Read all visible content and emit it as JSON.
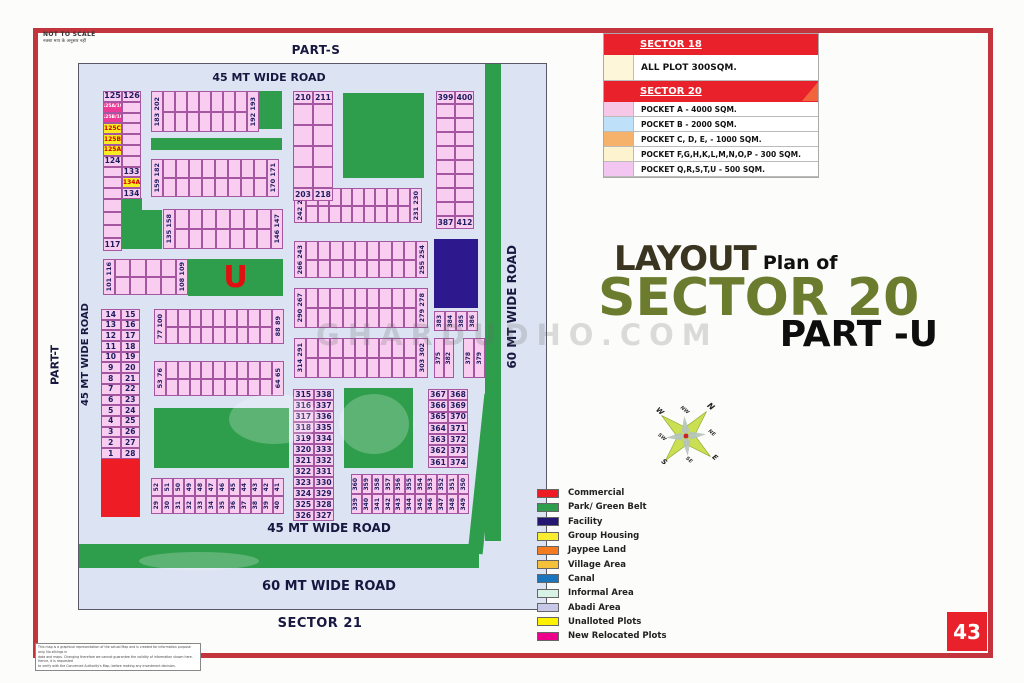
{
  "page": {
    "number": "43",
    "not_to_scale": "NOT TO SCALE",
    "not_to_scale_sub": "नक्शा माप के अनुसार नहीं",
    "watermark": "GHARDUDHO.COM",
    "disclaimer": {
      "l1": "This map is a graphical representation of the actual Map and is created for information purpose only. No sittings in",
      "l2": "data and maps. Changing therefore we cannot guarantee the validity of information shown here. Hence, it is requested",
      "l3": "to verify with the Concerned Authority's Map, before making any investment decision."
    }
  },
  "title": {
    "layout": "LAYOUT",
    "plan_of": "Plan of",
    "sector": "SECTOR 20",
    "part": "PART -U"
  },
  "legend_top": {
    "sector18_header": "SECTOR 18",
    "sector18_row": {
      "color": "#fdf6d8",
      "label": "ALL PLOT  300SQM."
    },
    "sector20_header": "SECTOR 20",
    "rows": [
      {
        "color": "#f6c7e7",
        "label": "POCKET A    -   4000 SQM."
      },
      {
        "color": "#bfe0f9",
        "label": "POCKET B    -   2000 SQM."
      },
      {
        "color": "#f6b26b",
        "label": "POCKET C, D, E, - 1000 SQM."
      },
      {
        "color": "#fdf3cf",
        "label": "POCKET  F,G,H,K,L,M,N,O,P  -  300 SQM."
      },
      {
        "color": "#f3c5f1",
        "label": "POCKET Q,R,S,T,U   -  500 SQM."
      }
    ]
  },
  "legend_bottom": {
    "items": [
      {
        "color": "#ed1c24",
        "label": "Commercial"
      },
      {
        "color": "#2f9e4c",
        "label": "Park/ Green Belt"
      },
      {
        "color": "#241773",
        "label": "Facility"
      },
      {
        "color": "#f9ed32",
        "label": "Group Housing"
      },
      {
        "color": "#f47b20",
        "label": "Jaypee Land"
      },
      {
        "color": "#f5c03a",
        "label": "Village Area"
      },
      {
        "color": "#1b75bc",
        "label": "Canal"
      },
      {
        "color": "#d9f2e6",
        "label": "Informal Area"
      },
      {
        "color": "#c7c8e8",
        "label": "Abadi Area"
      },
      {
        "color": "#fff200",
        "label": "Unalloted Plots"
      },
      {
        "color": "#ec008c",
        "label": "New Relocated Plots"
      }
    ]
  },
  "compass": {
    "labels": [
      "N",
      "NE",
      "E",
      "SE",
      "S",
      "SW",
      "W",
      "NW"
    ]
  },
  "map_labels": {
    "part_s": "PART-S",
    "part_t": "PART-T",
    "sector_21": "SECTOR 21"
  },
  "colors": {
    "green": "#2f9e4c",
    "navy": "#2e188e",
    "red": "#ee1c25",
    "magenta": "#ee3a97",
    "yellow": "#f9ec20",
    "plot": "#f8cdf0"
  },
  "map": {
    "blocks": [
      {
        "kind": "rect",
        "name": "green-belt-right",
        "x": 406,
        "y": 0,
        "w": 16,
        "h": 477,
        "color": "green"
      },
      {
        "kind": "rect",
        "name": "green-belt-right-lower",
        "x": 397,
        "y": 330,
        "w": 15,
        "h": 160,
        "color": "green",
        "tilt": 6
      },
      {
        "kind": "rect",
        "name": "park-band-top",
        "x": 72,
        "y": 74,
        "w": 131,
        "h": 12,
        "color": "green"
      },
      {
        "kind": "rect",
        "name": "park-square-small",
        "x": 180,
        "y": 27,
        "w": 23,
        "h": 38,
        "color": "green"
      },
      {
        "kind": "rect",
        "name": "park-square-large",
        "x": 264,
        "y": 29,
        "w": 81,
        "h": 85,
        "color": "green"
      },
      {
        "kind": "rect",
        "name": "park-L-upper",
        "x": 42,
        "y": 134,
        "w": 21,
        "h": 51,
        "color": "green"
      },
      {
        "kind": "rect",
        "name": "park-L-foot",
        "x": 63,
        "y": 146,
        "w": 20,
        "h": 39,
        "color": "green"
      },
      {
        "kind": "rect",
        "name": "park-left",
        "x": 75,
        "y": 344,
        "w": 135,
        "h": 60,
        "color": "green"
      },
      {
        "kind": "rect",
        "name": "park-right",
        "x": 265,
        "y": 324,
        "w": 69,
        "h": 80,
        "color": "green"
      },
      {
        "kind": "rect",
        "name": "green-band-bottom",
        "x": 0,
        "y": 480,
        "w": 400,
        "h": 24,
        "color": "green"
      },
      {
        "kind": "rect",
        "name": "facility-block",
        "x": 355,
        "y": 175,
        "w": 44,
        "h": 69,
        "color": "navy"
      },
      {
        "kind": "rect",
        "name": "commercial-block",
        "x": 22,
        "y": 395,
        "w": 39,
        "h": 58,
        "color": "red"
      },
      {
        "kind": "upark",
        "name": "park-u-block",
        "x": 109,
        "y": 195,
        "w": 95,
        "h": 37,
        "u": "U"
      },
      {
        "kind": "cellgrid",
        "name": "block-125-134",
        "x": 24,
        "y": 27,
        "cw": [
          19,
          19
        ],
        "rh": 10.8,
        "rows": [
          [
            {
              "t": "125",
              "fs": 8
            },
            {
              "t": "126",
              "fs": 8
            }
          ],
          [
            {
              "t": "125A/19",
              "bg": "magenta",
              "fg": "#fff",
              "fs": 4.5
            },
            {}
          ],
          [
            {
              "t": "125B/19",
              "bg": "magenta",
              "fg": "#fff",
              "fs": 4.5
            },
            {}
          ],
          [
            {
              "t": "125C",
              "bg": "yellow",
              "fg": "#c00",
              "fs": 6
            },
            {}
          ],
          [
            {
              "t": "125B",
              "bg": "yellow",
              "fg": "#c00",
              "fs": 6
            },
            {}
          ],
          [
            {
              "t": "125A",
              "bg": "yellow",
              "fg": "#c00",
              "fs": 6
            },
            {}
          ],
          [
            {
              "t": "124",
              "fs": 7.5
            },
            {}
          ],
          [
            {},
            {
              "t": "133",
              "fs": 7.5
            }
          ],
          [
            {},
            {
              "t": "134A",
              "bg": "yellow",
              "fg": "#c00",
              "fs": 6
            }
          ],
          [
            {},
            {
              "t": "134",
              "fs": 7.5
            }
          ]
        ]
      },
      {
        "kind": "cellgrid",
        "name": "block-117",
        "x": 24,
        "y": 135,
        "cw": [
          19
        ],
        "rh": 13,
        "rows": [
          [
            {}
          ],
          [
            {}
          ],
          [
            {}
          ],
          [
            {
              "t": "117",
              "fs": 7.5
            }
          ]
        ]
      },
      {
        "kind": "hstrip",
        "name": "strip-183-202",
        "x": 72,
        "y": 27,
        "w": 108,
        "h": 41,
        "cols": 7,
        "capL": "183 202",
        "capR": "192 193"
      },
      {
        "kind": "hstrip",
        "name": "strip-159-182",
        "x": 72,
        "y": 95,
        "w": 128,
        "h": 38,
        "cols": 8,
        "capL": "159 182",
        "capR": "170 171"
      },
      {
        "kind": "hstrip",
        "name": "strip-135-158",
        "x": 84,
        "y": 145,
        "w": 120,
        "h": 40,
        "cols": 7,
        "capL": "135 158",
        "capR": "146 147"
      },
      {
        "kind": "hstrip",
        "name": "strip-242-219",
        "x": 215,
        "y": 124,
        "w": 128,
        "h": 35,
        "cols": 9,
        "capL": "242 219",
        "capR": "231 230"
      },
      {
        "kind": "hstrip",
        "name": "strip-266-243",
        "x": 215,
        "y": 177,
        "w": 134,
        "h": 37,
        "cols": 9,
        "capL": "266 243",
        "capR": "255 254"
      },
      {
        "kind": "hstrip",
        "name": "strip-290-267",
        "x": 215,
        "y": 224,
        "w": 134,
        "h": 40,
        "cols": 9,
        "capL": "290 267",
        "capR": "279 278"
      },
      {
        "kind": "hstrip",
        "name": "strip-314-291",
        "x": 215,
        "y": 274,
        "w": 134,
        "h": 40,
        "cols": 9,
        "capL": "314 291",
        "capR": "303 302"
      },
      {
        "kind": "hstrip",
        "name": "strip-77-100",
        "x": 75,
        "y": 245,
        "w": 130,
        "h": 35,
        "cols": 9,
        "capL": "77 100",
        "capR": "88 89"
      },
      {
        "kind": "hstrip",
        "name": "strip-53-76",
        "x": 75,
        "y": 297,
        "w": 130,
        "h": 35,
        "cols": 9,
        "capL": "53 76",
        "capR": "64 65"
      },
      {
        "kind": "hstrip",
        "name": "strip-101-116",
        "x": 24,
        "y": 195,
        "w": 85,
        "h": 36,
        "cols": 4,
        "capL": "101 116",
        "capR": "108 109"
      },
      {
        "kind": "grid2",
        "name": "block-210-218",
        "x": 214,
        "y": 27,
        "w": 40,
        "h": 110,
        "top": [
          "210",
          "211"
        ],
        "bottom": [
          "203",
          "218"
        ],
        "mid": 4
      },
      {
        "kind": "grid2",
        "name": "block-399-412",
        "x": 357,
        "y": 27,
        "w": 38,
        "h": 138,
        "top": [
          "399",
          "400"
        ],
        "bottom": [
          "387",
          "412"
        ],
        "mid": 8
      },
      {
        "kind": "vcells",
        "name": "block-383-386",
        "x": 355,
        "y": 247,
        "w": 44,
        "h": 20,
        "labels": [
          "383",
          "384",
          "385",
          "386"
        ]
      },
      {
        "kind": "vcells",
        "name": "block-375-382",
        "x": 355,
        "y": 274,
        "w": 20,
        "h": 40,
        "labels": [
          "375",
          "382"
        ]
      },
      {
        "kind": "vcells",
        "name": "block-378-379",
        "x": 384,
        "y": 274,
        "w": 22,
        "h": 40,
        "labels": [
          "378",
          "379"
        ]
      },
      {
        "kind": "vpairs",
        "name": "strip-29-52",
        "x": 72,
        "y": 414,
        "w": 133,
        "h": 36,
        "top": [
          "52",
          "51",
          "50",
          "49",
          "48",
          "47",
          "46",
          "45",
          "44",
          "43",
          "42",
          "41"
        ],
        "bottom": [
          "29",
          "30",
          "31",
          "32",
          "33",
          "34",
          "35",
          "36",
          "37",
          "38",
          "39",
          "40"
        ]
      },
      {
        "kind": "vpairs",
        "name": "strip-339-360",
        "x": 272,
        "y": 410,
        "w": 118,
        "h": 40,
        "top": [
          "360",
          "359",
          "358",
          "357",
          "356",
          "355",
          "354",
          "353",
          "352",
          "351",
          "350"
        ],
        "bottom": [
          "339",
          "340",
          "341",
          "342",
          "343",
          "344",
          "345",
          "346",
          "347",
          "348",
          "349"
        ]
      },
      {
        "kind": "paircol",
        "name": "block-1-28",
        "x": 22,
        "y": 245,
        "w": 39,
        "rh": 10.7,
        "rows": [
          [
            "14",
            "15"
          ],
          [
            "13",
            "16"
          ],
          [
            "12",
            "17"
          ],
          [
            "11",
            "18"
          ],
          [
            "10",
            "19"
          ],
          [
            "9",
            "20"
          ],
          [
            "8",
            "21"
          ],
          [
            "7",
            "22"
          ],
          [
            "6",
            "23"
          ],
          [
            "5",
            "24"
          ],
          [
            "4",
            "25"
          ],
          [
            "3",
            "26"
          ],
          [
            "2",
            "27"
          ],
          [
            "1",
            "28"
          ]
        ]
      },
      {
        "kind": "paircol",
        "name": "block-315-338",
        "x": 214,
        "y": 325,
        "w": 41,
        "rh": 11,
        "rows": [
          [
            "315",
            "338"
          ],
          [
            "316",
            "337"
          ],
          [
            "317",
            "336"
          ],
          [
            "318",
            "335"
          ],
          [
            "319",
            "334"
          ],
          [
            "320",
            "333"
          ],
          [
            "321",
            "332"
          ],
          [
            "322",
            "331"
          ],
          [
            "323",
            "330"
          ],
          [
            "324",
            "329"
          ],
          [
            "325",
            "328"
          ],
          [
            "326",
            "327"
          ]
        ]
      },
      {
        "kind": "paircol",
        "name": "block-361-374",
        "x": 349,
        "y": 325,
        "w": 40,
        "rh": 11.3,
        "rows": [
          [
            "367",
            "368"
          ],
          [
            "366",
            "369"
          ],
          [
            "365",
            "370"
          ],
          [
            "364",
            "371"
          ],
          [
            "363",
            "372"
          ],
          [
            "362",
            "373"
          ],
          [
            "361",
            "374"
          ]
        ]
      },
      {
        "kind": "label",
        "name": "road-top-45mt",
        "x": 60,
        "y": 6,
        "w": 260,
        "h": 14,
        "text": "45 MT WIDE ROAD",
        "fs": 11
      },
      {
        "kind": "label",
        "name": "road-left-45mt",
        "x": -2,
        "y": 215,
        "w": 16,
        "h": 150,
        "text": "45 MT WIDE ROAD",
        "fs": 10,
        "rot": true
      },
      {
        "kind": "label",
        "name": "road-right-60mt",
        "x": 424,
        "y": 150,
        "w": 18,
        "h": 185,
        "text": "60 MT WIDE ROAD",
        "fs": 12,
        "rot": true
      },
      {
        "kind": "label",
        "name": "road-bottom-45mt",
        "x": 150,
        "y": 456,
        "w": 200,
        "h": 15,
        "text": "45 MT WIDE ROAD",
        "fs": 12
      },
      {
        "kind": "label",
        "name": "road-bottom-60mt",
        "x": 150,
        "y": 514,
        "w": 200,
        "h": 16,
        "text": "60 MT WIDE ROAD",
        "fs": 13
      }
    ]
  }
}
